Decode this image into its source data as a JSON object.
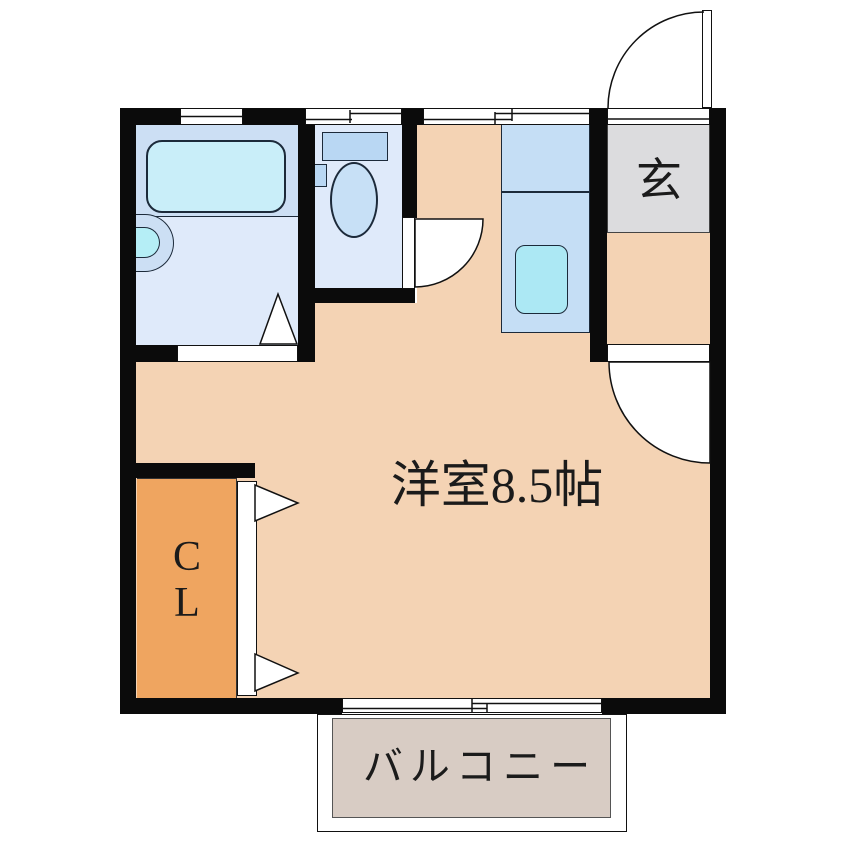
{
  "plan": {
    "rooms": {
      "living": {
        "label": "洋室8.5帖"
      },
      "entrance": {
        "label": "玄"
      },
      "closet": {
        "label": "CL",
        "label_lines": [
          "C",
          "L"
        ]
      },
      "balcony": {
        "label": "バルコニー"
      }
    },
    "icons": {
      "bathtub": "rounded-rect cyan tub",
      "shower-faucet": "half-disc on wall",
      "toilet-tank": "rect",
      "toilet-bowl": "ellipse",
      "kitchen-sink": "rounded-rect cyan",
      "door-swing": "quarter-circle arc",
      "folding-door": "triangle marks",
      "sliding-window": "offset double lines"
    },
    "colors": {
      "wall": "#0b0b0b",
      "room_floor": "#f4d3b4",
      "closet": "#efa560",
      "entrance_floor": "#dcdcde",
      "bath_band": "#ccdff4",
      "bath_floor": "#dfeafa",
      "kitchen_counter": "#c5def5",
      "tub": "#c9eef9",
      "sink": "#ace8f4",
      "fixture_blue": "#b9d7f3",
      "bowl_blue": "#c7e0f6",
      "shower_inner": "#b5eef6",
      "balcony_floor": "#d8ccc4",
      "outline": "#1c2a3a",
      "text": "#1b1b1b"
    }
  }
}
